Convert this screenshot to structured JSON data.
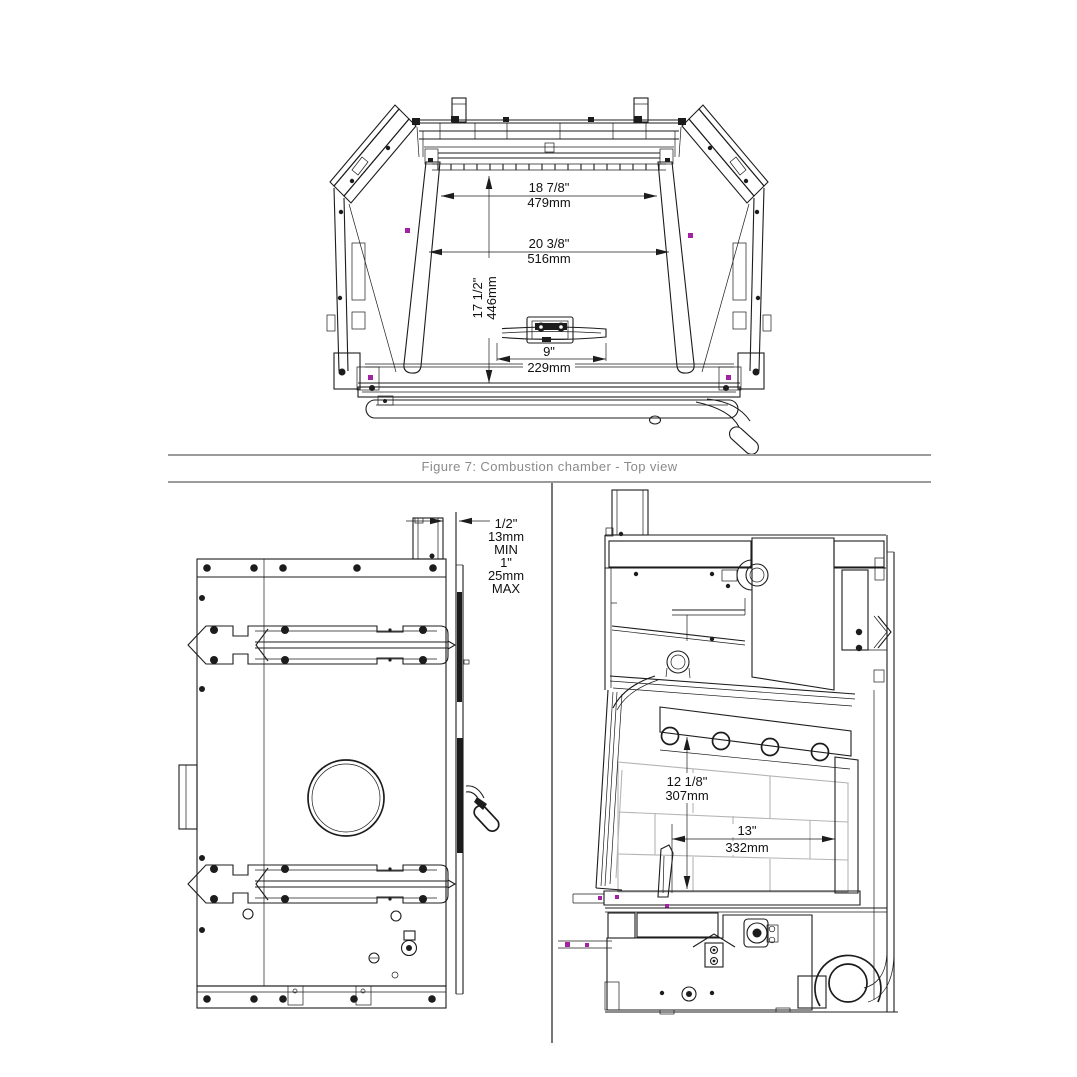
{
  "caption": {
    "text": "Figure 7: Combustion chamber - Top view"
  },
  "colors": {
    "line": "#1c1c1c",
    "caption_gray": "#8a8a8a",
    "rule_gray": "#9b9b9b",
    "brick_gray": "#b4b4b4",
    "accent_magenta": "#a321a3"
  },
  "top_view": {
    "title": "Combustion chamber top view",
    "dim_rear_width": {
      "in": "18 7/8\"",
      "mm": "479mm"
    },
    "dim_front_width": {
      "in": "20 3/8\"",
      "mm": "516mm"
    },
    "dim_depth": {
      "in": "17 1/2\"",
      "mm": "446mm"
    },
    "dim_damper_width": {
      "in": "9\"",
      "mm": "229mm"
    }
  },
  "rear_view": {
    "title": "Rear clearance view",
    "clearance_lines": [
      "1/2\"",
      "13mm",
      "MIN",
      "1\"",
      "25mm",
      "MAX"
    ]
  },
  "side_view": {
    "title": "Side section view",
    "dim_firebox_height": {
      "in": "12 1/8\"",
      "mm": "307mm"
    },
    "dim_firebox_depth": {
      "in": "13\"",
      "mm": "332mm"
    }
  }
}
